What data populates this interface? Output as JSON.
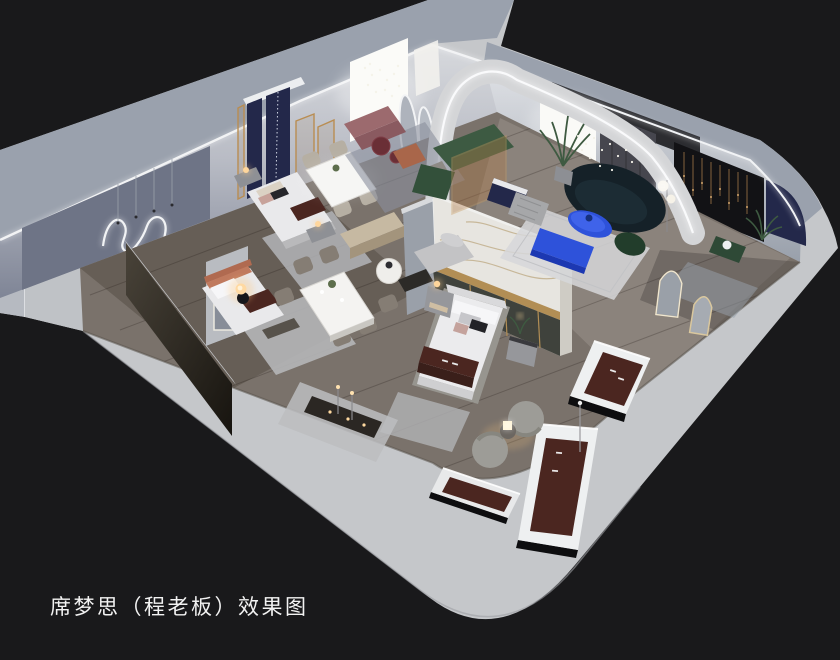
{
  "caption": {
    "text": "席梦思（程老板）效果图"
  },
  "scene": {
    "kind": "isometric-cutaway-interior-render",
    "subject": "mattress showroom floor plan",
    "areas": [
      "bedroom-display-left",
      "bedroom-display-mid",
      "dining-display",
      "living-lounge",
      "master-bed-display",
      "mattress-display-corner",
      "mirror-corner"
    ]
  },
  "palette": {
    "background": "#19191b",
    "slab": "#c5c7ca",
    "wallBand": "#9aa1ad",
    "artWall": "#6e7486",
    "floorWood": "#7a726b",
    "rug": "#b5b6b8",
    "accentBlue": "#2e52da",
    "accentBlueDark": "#1c38b2",
    "sofaGreen": "#3d5a42",
    "sofaTeal": "#152128",
    "runnerBrown": "#4b2620",
    "rustAccent": "#b06a50",
    "navyPanel": "#23284a",
    "gold": "#b28e55",
    "ledWhite": "#f7f8fa",
    "lampWarm": "#ffd9a2",
    "marble": "#e7e5e0"
  }
}
